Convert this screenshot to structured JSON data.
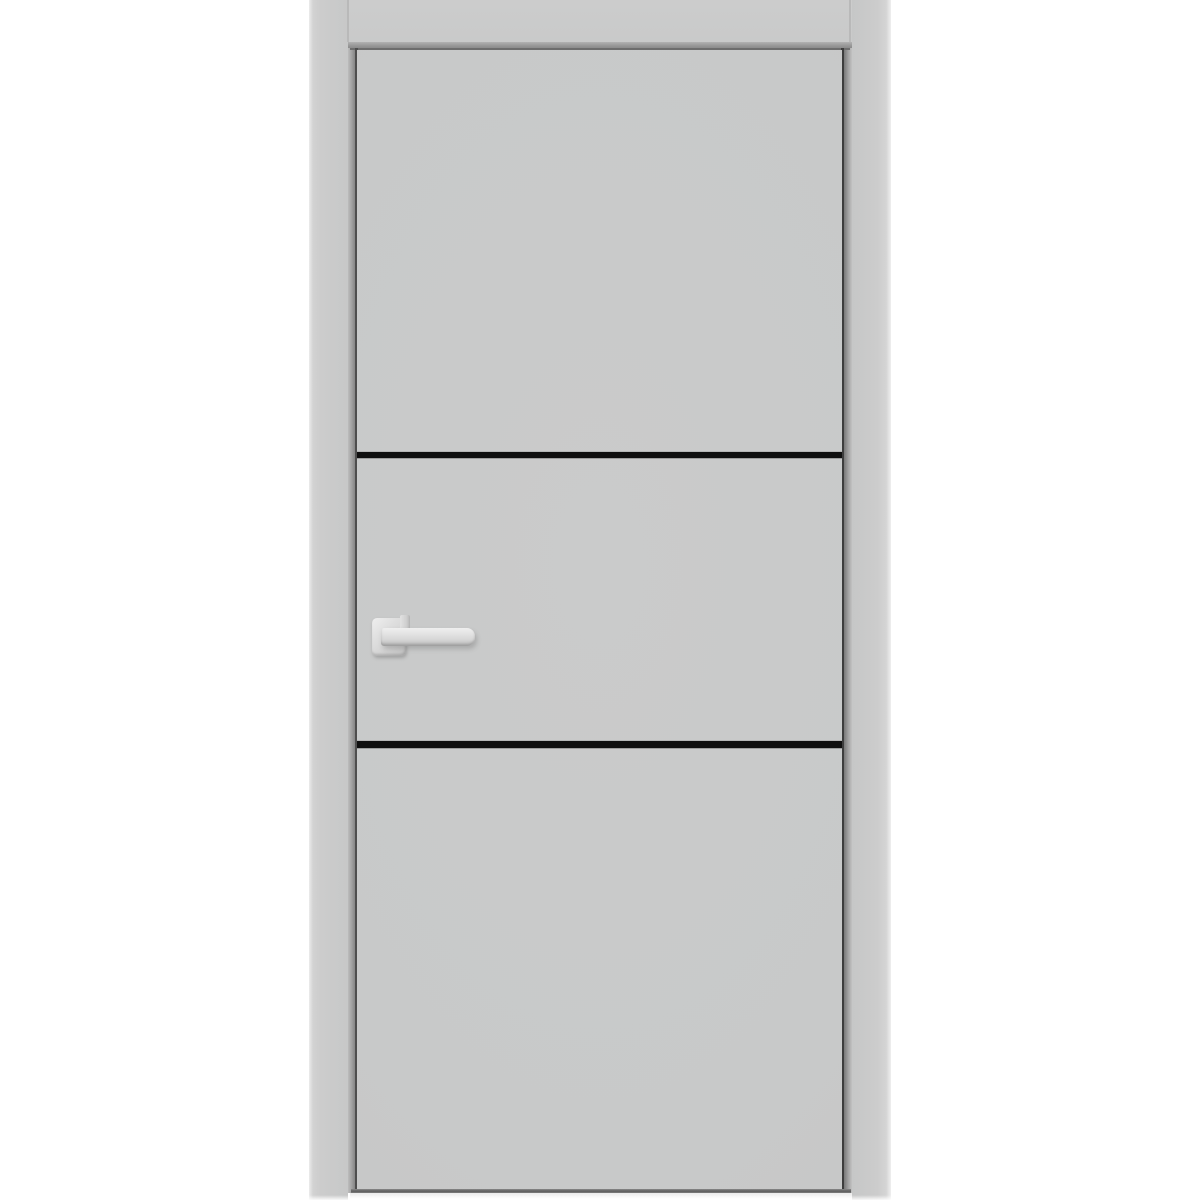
{
  "scene": {
    "description": "Product photo of a modern light-gray interior door with frame, two horizontal black aluminum inlay stripes and a silver square-rosette lever handle on the left side",
    "objects": {
      "door_frame": {
        "label": "door frame casing",
        "parts": [
          "head",
          "left jamb",
          "right jamb"
        ]
      },
      "door_slab": {
        "label": "flush door slab",
        "finish": "matte light gray"
      },
      "inlay_stripes": {
        "label": "horizontal black inlay stripes",
        "count": 2,
        "positions": [
          "upper third of slab",
          "lower two-thirds of slab"
        ]
      },
      "handle": {
        "label": "lever door handle",
        "parts": [
          "square rosette",
          "neck",
          "straight lever"
        ],
        "finish": "brushed silver",
        "side": "left"
      }
    }
  },
  "colors": {
    "background": "#ffffff",
    "frame": "#cccccc",
    "door_face": "#c8c9c9",
    "reveal_shadow": "#8d8d8d",
    "door_edge_dark": "#4a4a4a",
    "stripe_black": "#0f0f0f",
    "handle_light": "#efefef",
    "handle_mid": "#d6d6d6",
    "handle_shadow": "#b7b7b7",
    "floor_light": "#ebebeb"
  }
}
